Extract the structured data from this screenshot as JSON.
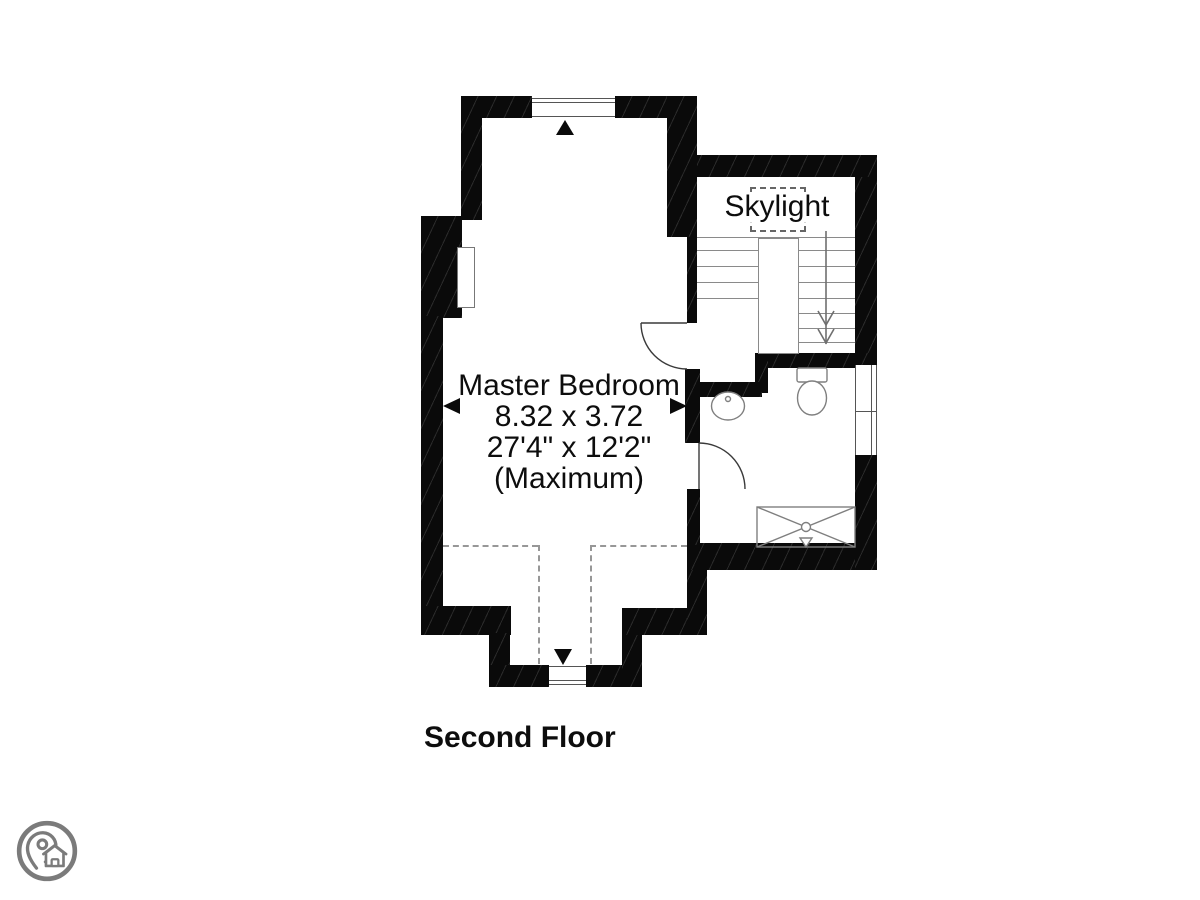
{
  "floor_plan": {
    "floor_label": "Second Floor",
    "skylight_label": "Skylight",
    "master_bedroom": {
      "name": "Master Bedroom",
      "size_metric": "8.32 x 3.72",
      "size_imperial": "27'4\" x 12'2\"",
      "size_qualifier": "(Maximum)"
    },
    "stairs": {
      "direction_icon": "stair-down-arrow-icon",
      "treads_left": 4,
      "treads_right": 7
    },
    "fixture_icons": [
      "sink-icon",
      "toilet-icon",
      "shower-icon"
    ],
    "marker_icons": [
      "window-marker-up-icon",
      "window-marker-down-icon",
      "dimension-arrow-left-icon",
      "dimension-arrow-right-icon"
    ],
    "logo_icon": "map-pin-home-logo-icon",
    "colors": {
      "walls": "#0a0a0a",
      "fixture_lines": "#7f7f7f",
      "dashed_ceiling_lines": "#979797",
      "skylight_dashes": "#666666",
      "text": "#0d0d0d",
      "logo": "#7b7b7b",
      "background": "#ffffff"
    }
  }
}
